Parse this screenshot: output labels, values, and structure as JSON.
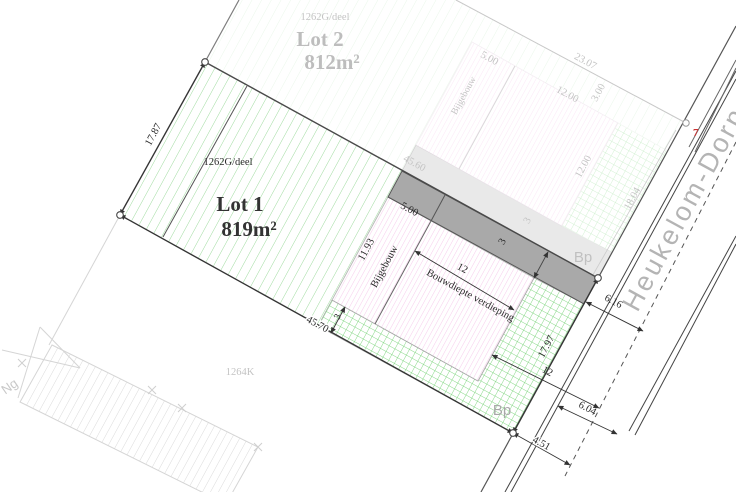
{
  "plan": {
    "street": {
      "name": "Heukelom-Dorp",
      "house_number": "7"
    },
    "lot1": {
      "title": "Lot 1",
      "area": "819m²",
      "parcel": "1262G/deel",
      "boundary_marker": "Bp",
      "dims": {
        "west": "17.87",
        "south": "45.70",
        "front": "17.97",
        "bijgebouw_depth": "11.93",
        "bijgebouw_width": "5.00",
        "bouwdiepte": "12",
        "bouwdiepte_label": "Bouwdiepte verdieping",
        "bijgebouw_label": "Bijgebouw",
        "rear_strip": "3",
        "side_strip": "3"
      }
    },
    "lot2": {
      "title": "Lot 2",
      "area": "812m²",
      "parcel": "1262G/deel",
      "boundary_marker": "Bp",
      "dims": {
        "north": "23.07",
        "division": "45.60",
        "bijgebouw_width": "5.00",
        "bouwdiepte": "12.00",
        "north_strip": "3.00",
        "depth": "12.00",
        "frontage": "18.04",
        "side_strip": "3",
        "bijgebouw_label": "Bijgebouw"
      }
    },
    "road_dims": {
      "to_axis_north": "6.16",
      "bouwdiepte_projection": "12",
      "to_axis_south": "6.04",
      "south_corner": "4.51"
    },
    "neighbors": {
      "south": "1264K",
      "northwest": "Ng"
    }
  }
}
